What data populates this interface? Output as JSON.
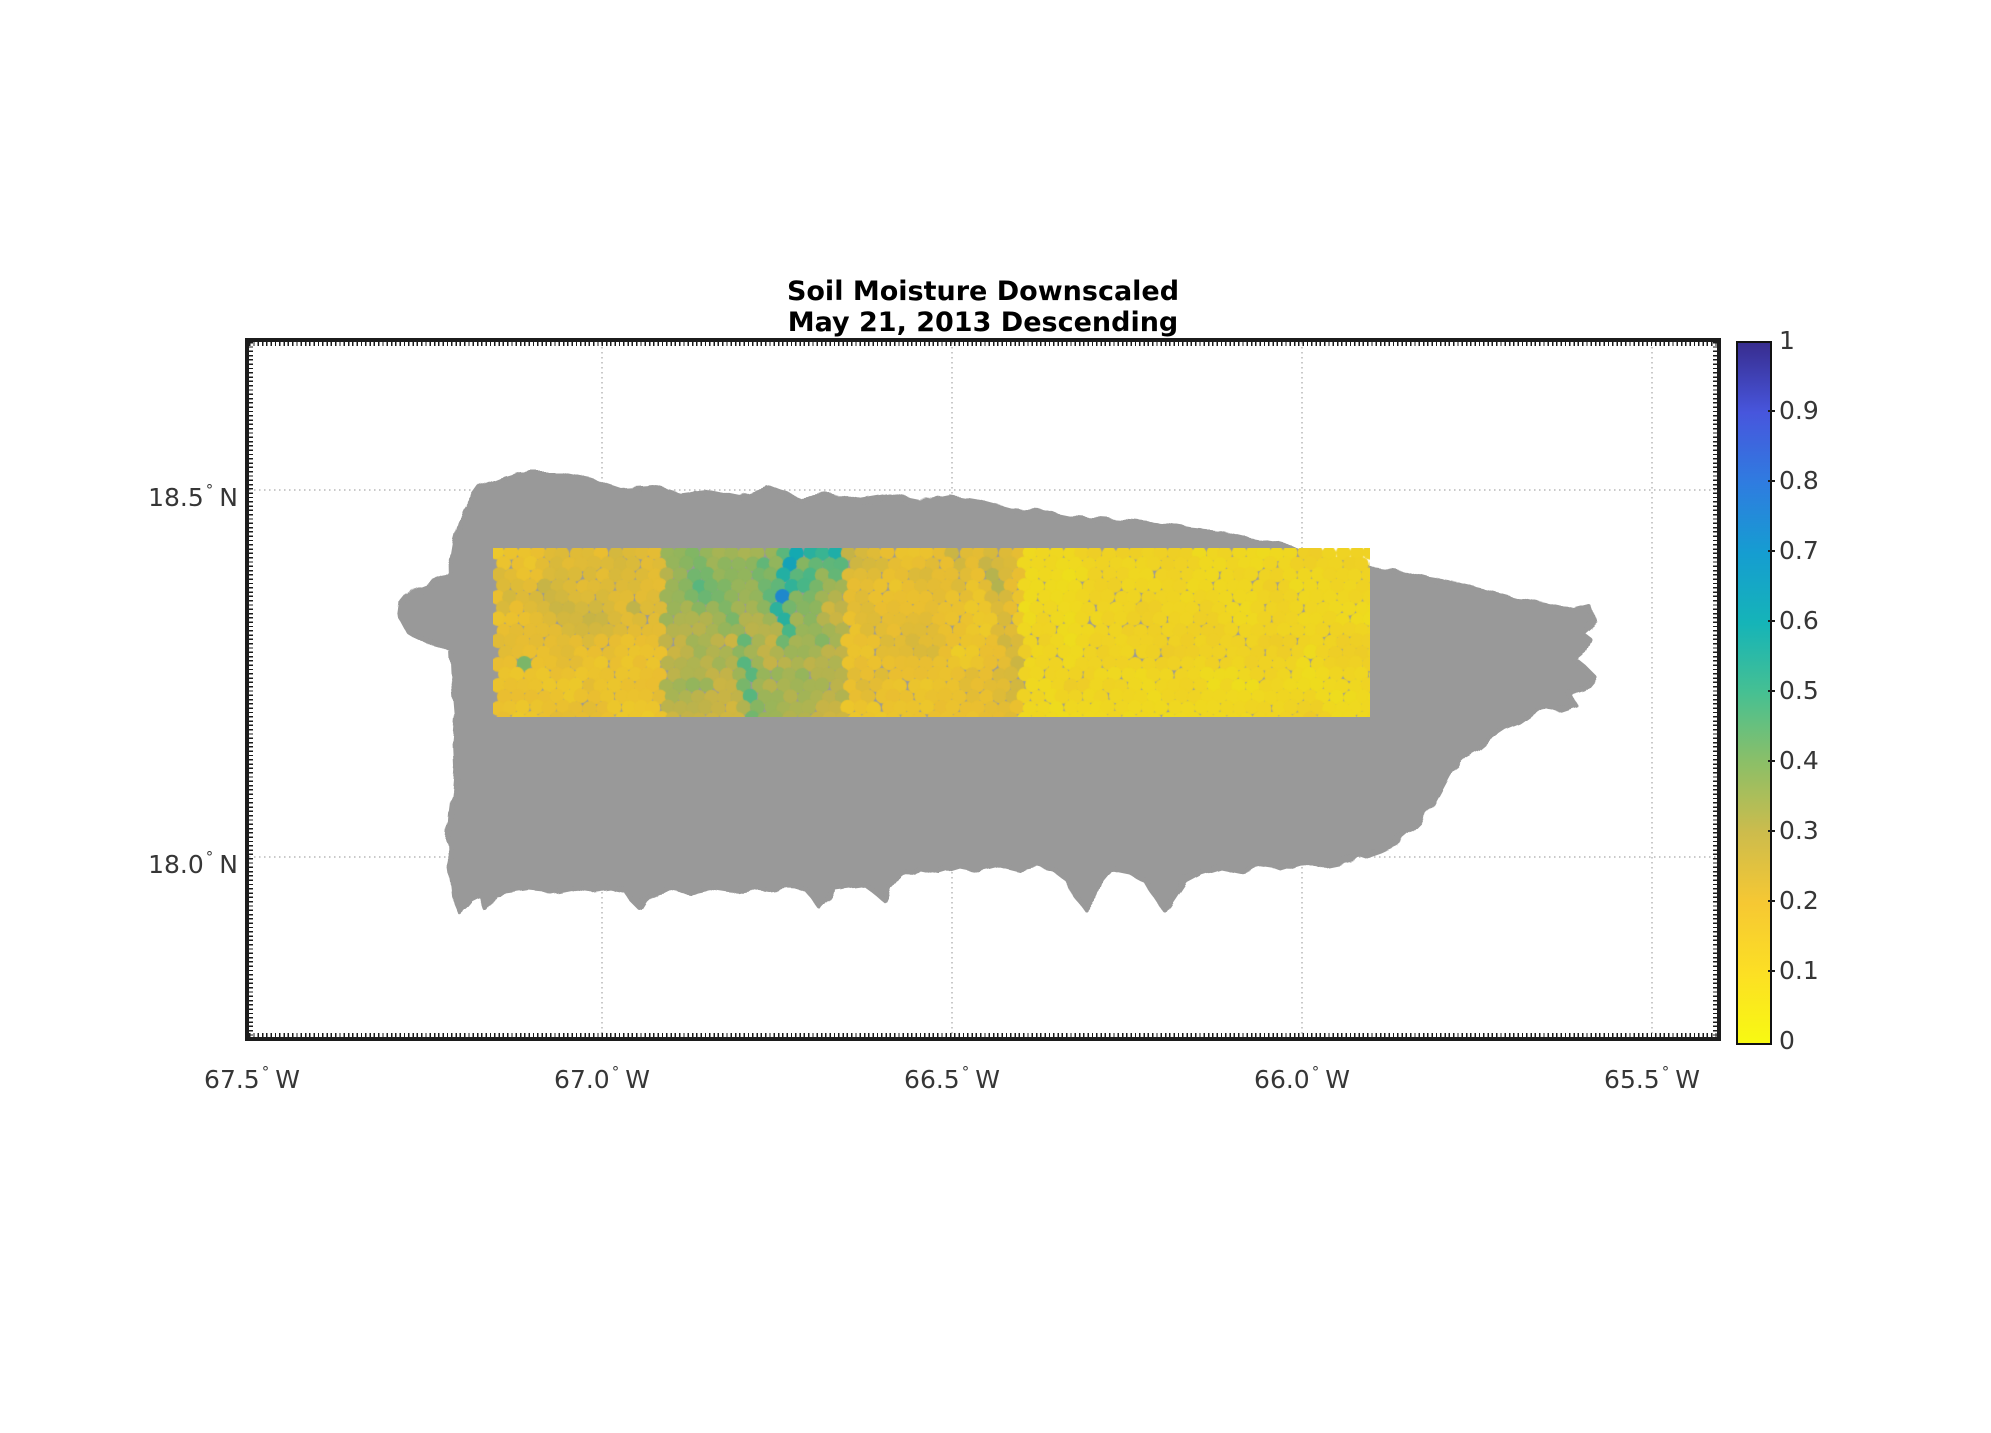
{
  "figure": {
    "width": 1991,
    "height": 1433,
    "background": "#ffffff"
  },
  "title": {
    "line1": "Soil Moisture Downscaled",
    "line2": "May 21, 2013 Descending"
  },
  "axes": {
    "plot": {
      "left": 249,
      "top": 342,
      "width": 1468,
      "height": 695
    },
    "border_color": "#1c1c1c",
    "gridline_color": "#c9c9c9",
    "tick_label_color": "#363636",
    "x_ticks": [
      {
        "label": "67.5",
        "hemisphere": "W",
        "x": 252
      },
      {
        "label": "67.0",
        "hemisphere": "W",
        "x": 602
      },
      {
        "label": "66.5",
        "hemisphere": "W",
        "x": 952
      },
      {
        "label": "66.0",
        "hemisphere": "W",
        "x": 1302
      },
      {
        "label": "65.5",
        "hemisphere": "W",
        "x": 1652
      }
    ],
    "y_ticks": [
      {
        "label": "18.5",
        "hemisphere": "N",
        "y": 490
      },
      {
        "label": "18.0",
        "hemisphere": "N",
        "y": 857
      }
    ],
    "gridlines_x": [
      353,
      703,
      1053,
      1403
    ],
    "gridlines_y": [
      148,
      515
    ]
  },
  "colorbar": {
    "left": 1736,
    "top": 341,
    "width": 32,
    "height": 700,
    "min": 0,
    "max": 1,
    "tick_values": [
      0,
      0.1,
      0.2,
      0.3,
      0.4,
      0.5,
      0.6,
      0.7,
      0.8,
      0.9,
      1
    ],
    "tick_labels": [
      "0",
      "0.1",
      "0.2",
      "0.3",
      "0.4",
      "0.5",
      "0.6",
      "0.7",
      "0.8",
      "0.9",
      "1"
    ],
    "label_x": 1779
  },
  "chart_data": {
    "type": "heatmap",
    "title": "Soil Moisture Downscaled May 21, 2013 Descending",
    "colormap": "parula-reversed",
    "value_range": [
      0,
      1
    ],
    "xlabel_ticks_deg_w": [
      67.5,
      67.0,
      66.5,
      66.0,
      65.5
    ],
    "ylabel_ticks_deg_n": [
      18.5,
      18.0
    ],
    "colormap_stops": [
      {
        "v": 0.0,
        "color": "#f8f912"
      },
      {
        "v": 0.1,
        "color": "#fcdf24"
      },
      {
        "v": 0.2,
        "color": "#f6c833"
      },
      {
        "v": 0.3,
        "color": "#cdbc4c"
      },
      {
        "v": 0.4,
        "color": "#8cbf67"
      },
      {
        "v": 0.5,
        "color": "#46c092"
      },
      {
        "v": 0.6,
        "color": "#15b4b8"
      },
      {
        "v": 0.7,
        "color": "#159dd1"
      },
      {
        "v": 0.8,
        "color": "#2f7ce0"
      },
      {
        "v": 0.9,
        "color": "#4756dd"
      },
      {
        "v": 1.0,
        "color": "#382d8f"
      }
    ],
    "island": {
      "name": "Puerto Rico landmass (no data)",
      "color": "#999999",
      "outline": [
        [
          231,
          146
        ],
        [
          251,
          138
        ],
        [
          271,
          132
        ],
        [
          311,
          132
        ],
        [
          341,
          138
        ],
        [
          371,
          148
        ],
        [
          401,
          146
        ],
        [
          431,
          154
        ],
        [
          461,
          150
        ],
        [
          491,
          156
        ],
        [
          521,
          146
        ],
        [
          551,
          158
        ],
        [
          581,
          154
        ],
        [
          611,
          160
        ],
        [
          641,
          155
        ],
        [
          671,
          161
        ],
        [
          701,
          155
        ],
        [
          731,
          160
        ],
        [
          761,
          168
        ],
        [
          791,
          170
        ],
        [
          821,
          176
        ],
        [
          851,
          178
        ],
        [
          881,
          180
        ],
        [
          911,
          183
        ],
        [
          941,
          188
        ],
        [
          971,
          191
        ],
        [
          1001,
          198
        ],
        [
          1031,
          203
        ],
        [
          1061,
          211
        ],
        [
          1091,
          218
        ],
        [
          1121,
          226
        ],
        [
          1151,
          230
        ],
        [
          1181,
          238
        ],
        [
          1211,
          243
        ],
        [
          1241,
          250
        ],
        [
          1271,
          258
        ],
        [
          1296,
          263
        ],
        [
          1311,
          266
        ],
        [
          1326,
          270
        ],
        [
          1341,
          266
        ],
        [
          1345,
          278
        ],
        [
          1331,
          290
        ],
        [
          1341,
          298
        ],
        [
          1336,
          310
        ],
        [
          1326,
          318
        ],
        [
          1336,
          326
        ],
        [
          1346,
          336
        ],
        [
          1336,
          348
        ],
        [
          1321,
          353
        ],
        [
          1326,
          363
        ],
        [
          1311,
          368
        ],
        [
          1296,
          363
        ],
        [
          1281,
          373
        ],
        [
          1271,
          380
        ],
        [
          1256,
          386
        ],
        [
          1241,
          396
        ],
        [
          1229,
          406
        ],
        [
          1216,
          413
        ],
        [
          1206,
          423
        ],
        [
          1199,
          433
        ],
        [
          1191,
          448
        ],
        [
          1183,
          463
        ],
        [
          1171,
          478
        ],
        [
          1159,
          490
        ],
        [
          1146,
          501
        ],
        [
          1131,
          508
        ],
        [
          1111,
          515
        ],
        [
          1091,
          520
        ],
        [
          1071,
          524
        ],
        [
          1051,
          520
        ],
        [
          1031,
          526
        ],
        [
          1011,
          523
        ],
        [
          991,
          528
        ],
        [
          971,
          524
        ],
        [
          951,
          530
        ],
        [
          936,
          538
        ],
        [
          926,
          553
        ],
        [
          916,
          568
        ],
        [
          906,
          553
        ],
        [
          896,
          538
        ],
        [
          881,
          530
        ],
        [
          861,
          526
        ],
        [
          851,
          538
        ],
        [
          846,
          553
        ],
        [
          836,
          566
        ],
        [
          826,
          553
        ],
        [
          819,
          538
        ],
        [
          806,
          528
        ],
        [
          791,
          524
        ],
        [
          771,
          528
        ],
        [
          751,
          523
        ],
        [
          731,
          528
        ],
        [
          711,
          524
        ],
        [
          691,
          530
        ],
        [
          671,
          526
        ],
        [
          651,
          532
        ],
        [
          641,
          546
        ],
        [
          636,
          558
        ],
        [
          626,
          550
        ],
        [
          616,
          542
        ],
        [
          601,
          544
        ],
        [
          586,
          546
        ],
        [
          579,
          556
        ],
        [
          571,
          565
        ],
        [
          563,
          554
        ],
        [
          556,
          546
        ],
        [
          541,
          545
        ],
        [
          521,
          548
        ],
        [
          501,
          545
        ],
        [
          481,
          549
        ],
        [
          461,
          546
        ],
        [
          441,
          550
        ],
        [
          421,
          546
        ],
        [
          406,
          549
        ],
        [
          396,
          558
        ],
        [
          391,
          566
        ],
        [
          383,
          558
        ],
        [
          376,
          548
        ],
        [
          361,
          545
        ],
        [
          341,
          548
        ],
        [
          321,
          545
        ],
        [
          301,
          549
        ],
        [
          281,
          547
        ],
        [
          261,
          550
        ],
        [
          246,
          552
        ],
        [
          238,
          568
        ],
        [
          233,
          553
        ],
        [
          223,
          558
        ],
        [
          217,
          565
        ],
        [
          211,
          570
        ],
        [
          206,
          558
        ],
        [
          204,
          540
        ],
        [
          201,
          520
        ],
        [
          200,
          498
        ],
        [
          202,
          472
        ],
        [
          205,
          448
        ],
        [
          207,
          424
        ],
        [
          206,
          400
        ],
        [
          208,
          376
        ],
        [
          206,
          352
        ],
        [
          204,
          330
        ],
        [
          203,
          308
        ],
        [
          190,
          302
        ],
        [
          172,
          297
        ],
        [
          159,
          289
        ],
        [
          152,
          276
        ],
        [
          154,
          261
        ],
        [
          163,
          250
        ],
        [
          176,
          245
        ],
        [
          189,
          239
        ],
        [
          199,
          231
        ],
        [
          203,
          218
        ],
        [
          206,
          200
        ],
        [
          211,
          181
        ],
        [
          218,
          166
        ],
        [
          226,
          153
        ]
      ]
    },
    "strip": {
      "left": 244,
      "top": 206,
      "width": 877,
      "height": 169,
      "lat_extent_deg_n": [
        18.19,
        18.42
      ],
      "lon_extent_deg_w": [
        67.15,
        65.9
      ],
      "marker_spacing_px": 13,
      "marker_radius_px": 7.4,
      "darken": 0.95,
      "blocks": [
        {
          "x0": 0,
          "x1": 173,
          "base": 0.2,
          "ampL": 0.05,
          "ampS": 0.03
        },
        {
          "x0": 173,
          "x1": 350,
          "base": 0.32,
          "ampL": 0.06,
          "ampS": 0.04
        },
        {
          "x0": 350,
          "x1": 530,
          "base": 0.19,
          "ampL": 0.045,
          "ampS": 0.03
        },
        {
          "x0": 530,
          "x1": 877,
          "base": 0.1,
          "ampL": 0.03,
          "ampS": 0.02
        }
      ],
      "features": [
        {
          "seg": [
            20,
            35,
            150,
            95
          ],
          "r": 26,
          "dv": 0.055
        },
        {
          "seg": [
            12,
            50,
            16,
            58
          ],
          "r": 7,
          "dv": 0.22
        },
        {
          "seg": [
            55,
            38,
            60,
            44
          ],
          "r": 6,
          "dv": 0.18
        },
        {
          "seg": [
            28,
            110,
            32,
            118
          ],
          "r": 6,
          "dv": 0.22
        },
        {
          "seg": [
            95,
            20,
            100,
            24
          ],
          "r": 5,
          "dv": 0.15
        },
        {
          "seg": [
            140,
            60,
            146,
            66
          ],
          "r": 6,
          "dv": 0.12
        },
        {
          "seg": [
            180,
            0,
            350,
            10
          ],
          "r": 28,
          "dv": 0.05
        },
        {
          "seg": [
            300,
            0,
            290,
            55
          ],
          "r": 10,
          "dv": 0.3
        },
        {
          "seg": [
            290,
            55,
            297,
            95
          ],
          "r": 8,
          "dv": 0.26
        },
        {
          "seg": [
            250,
            95,
            260,
            165
          ],
          "r": 9,
          "dv": 0.16
        },
        {
          "seg": [
            320,
            5,
            313,
            35
          ],
          "r": 16,
          "dv": 0.12
        },
        {
          "seg": [
            270,
            20,
            280,
            60
          ],
          "r": 14,
          "dv": 0.1
        },
        {
          "seg": [
            340,
            0,
            345,
            25
          ],
          "r": 12,
          "dv": 0.14
        },
        {
          "seg": [
            300,
            0,
            345,
            8
          ],
          "r": 14,
          "dv": 0.18
        },
        {
          "seg": [
            230,
            40,
            240,
            80
          ],
          "r": 12,
          "dv": 0.08
        },
        {
          "seg": [
            200,
            20,
            215,
            50
          ],
          "r": 20,
          "dv": 0.09
        },
        {
          "seg": [
            310,
            50,
            330,
            90
          ],
          "r": 18,
          "dv": 0.08
        },
        {
          "seg": [
            235,
            110,
            255,
            140
          ],
          "r": 16,
          "dv": 0.07
        },
        {
          "seg": [
            498,
            15,
            515,
            95
          ],
          "r": 13,
          "dv": 0.11
        },
        {
          "seg": [
            462,
            5,
            472,
            45
          ],
          "r": 9,
          "dv": 0.09
        },
        {
          "seg": [
            530,
            100,
            520,
            150
          ],
          "r": 10,
          "dv": 0.07
        },
        {
          "seg": [
            355,
            5,
            420,
            25
          ],
          "r": 18,
          "dv": 0.04
        },
        {
          "seg": [
            545,
            120,
            560,
            160
          ],
          "r": 18,
          "dv": -0.02
        },
        {
          "seg": [
            535,
            0,
            535,
            169
          ],
          "r": 14,
          "dv": -0.02
        }
      ]
    }
  }
}
